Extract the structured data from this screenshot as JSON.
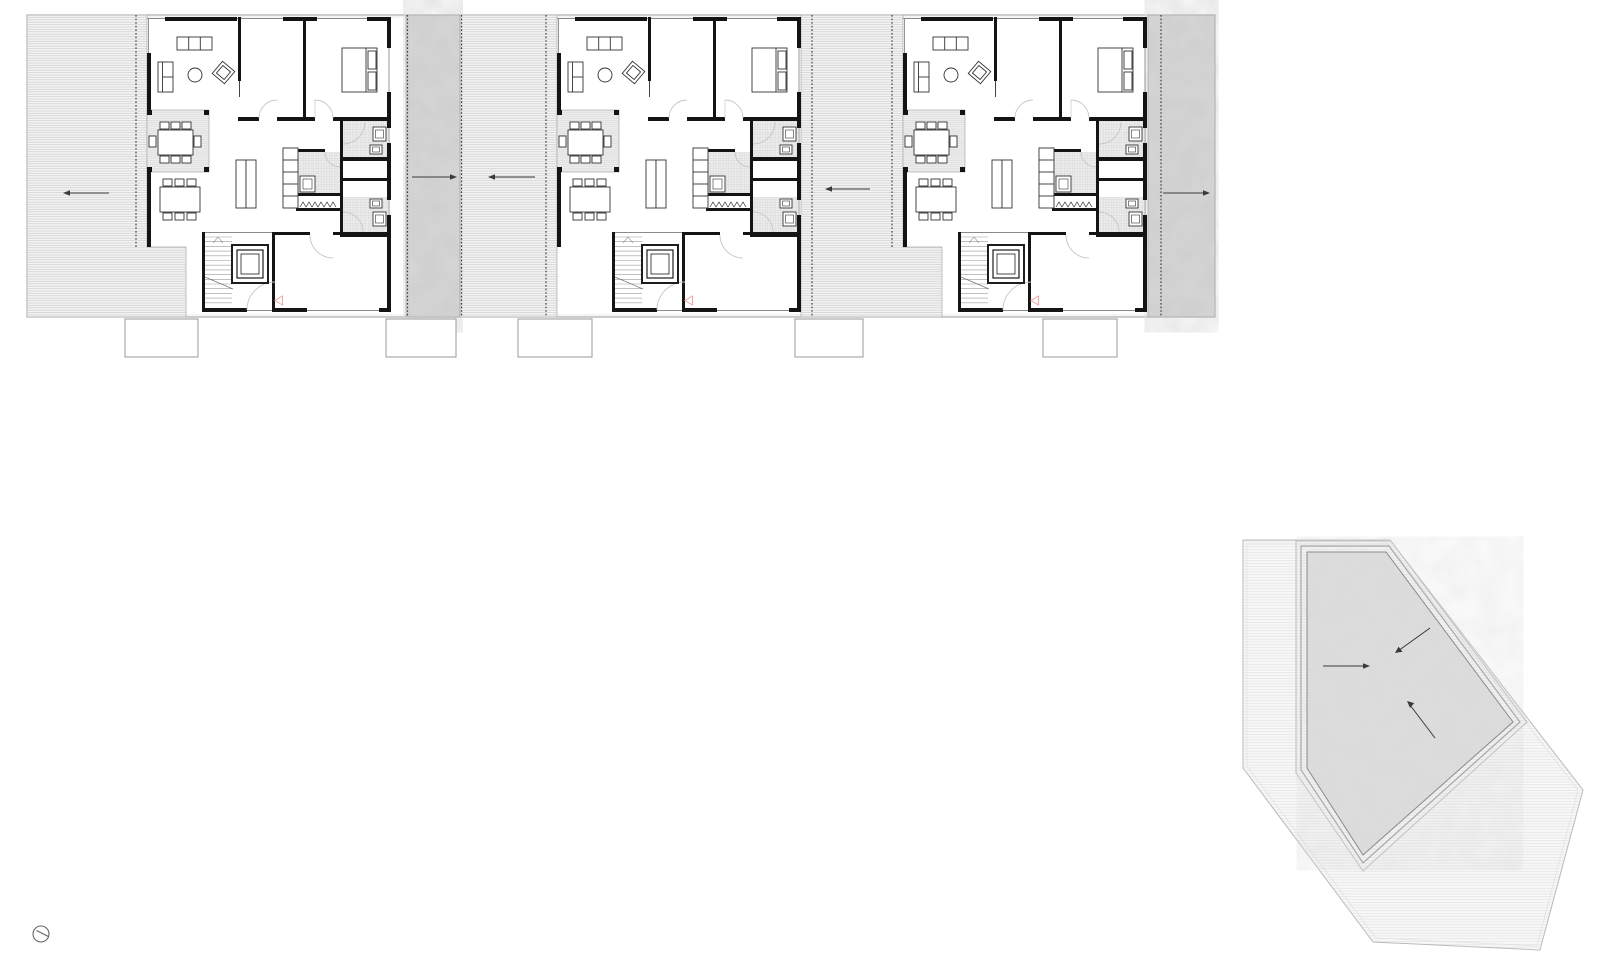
{
  "drawing": {
    "kind": "architectural-floor-plan",
    "units_count": 3,
    "site_plan_present": true,
    "north_symbol_present": true
  },
  "colors": {
    "wall": "#141414",
    "thin_line": "#8a8a8a",
    "arrow": "#3a3a3a",
    "entry_marker": "#efa6a2",
    "door_arc": "#c6c6c6",
    "concrete_base": "#cbcbcb",
    "site_concrete_base": "#d8d8d8",
    "hatch_bg": "#f3f3f3",
    "outline": "#999999"
  },
  "floor_plan": {
    "circulation_arrows": [
      {
        "area": "left-terrace",
        "direction": "left"
      },
      {
        "area": "passage-concrete-strip",
        "direction": "right"
      },
      {
        "area": "passage-walkway",
        "direction": "left"
      },
      {
        "area": "middle-terrace",
        "direction": "left"
      },
      {
        "area": "right-concrete-strip",
        "direction": "right"
      }
    ],
    "entry_markers": [
      {
        "unit": 1,
        "shape": "triangle-left"
      },
      {
        "unit": 2,
        "shape": "triangle-left"
      },
      {
        "unit": 3,
        "shape": "triangle-left"
      }
    ]
  },
  "site_plan": {
    "shape": "pentagon",
    "arrows": [
      {
        "direction": "down-left"
      },
      {
        "direction": "right"
      },
      {
        "direction": "up-left"
      }
    ]
  },
  "compass": {
    "type": "circle-with-needle"
  }
}
